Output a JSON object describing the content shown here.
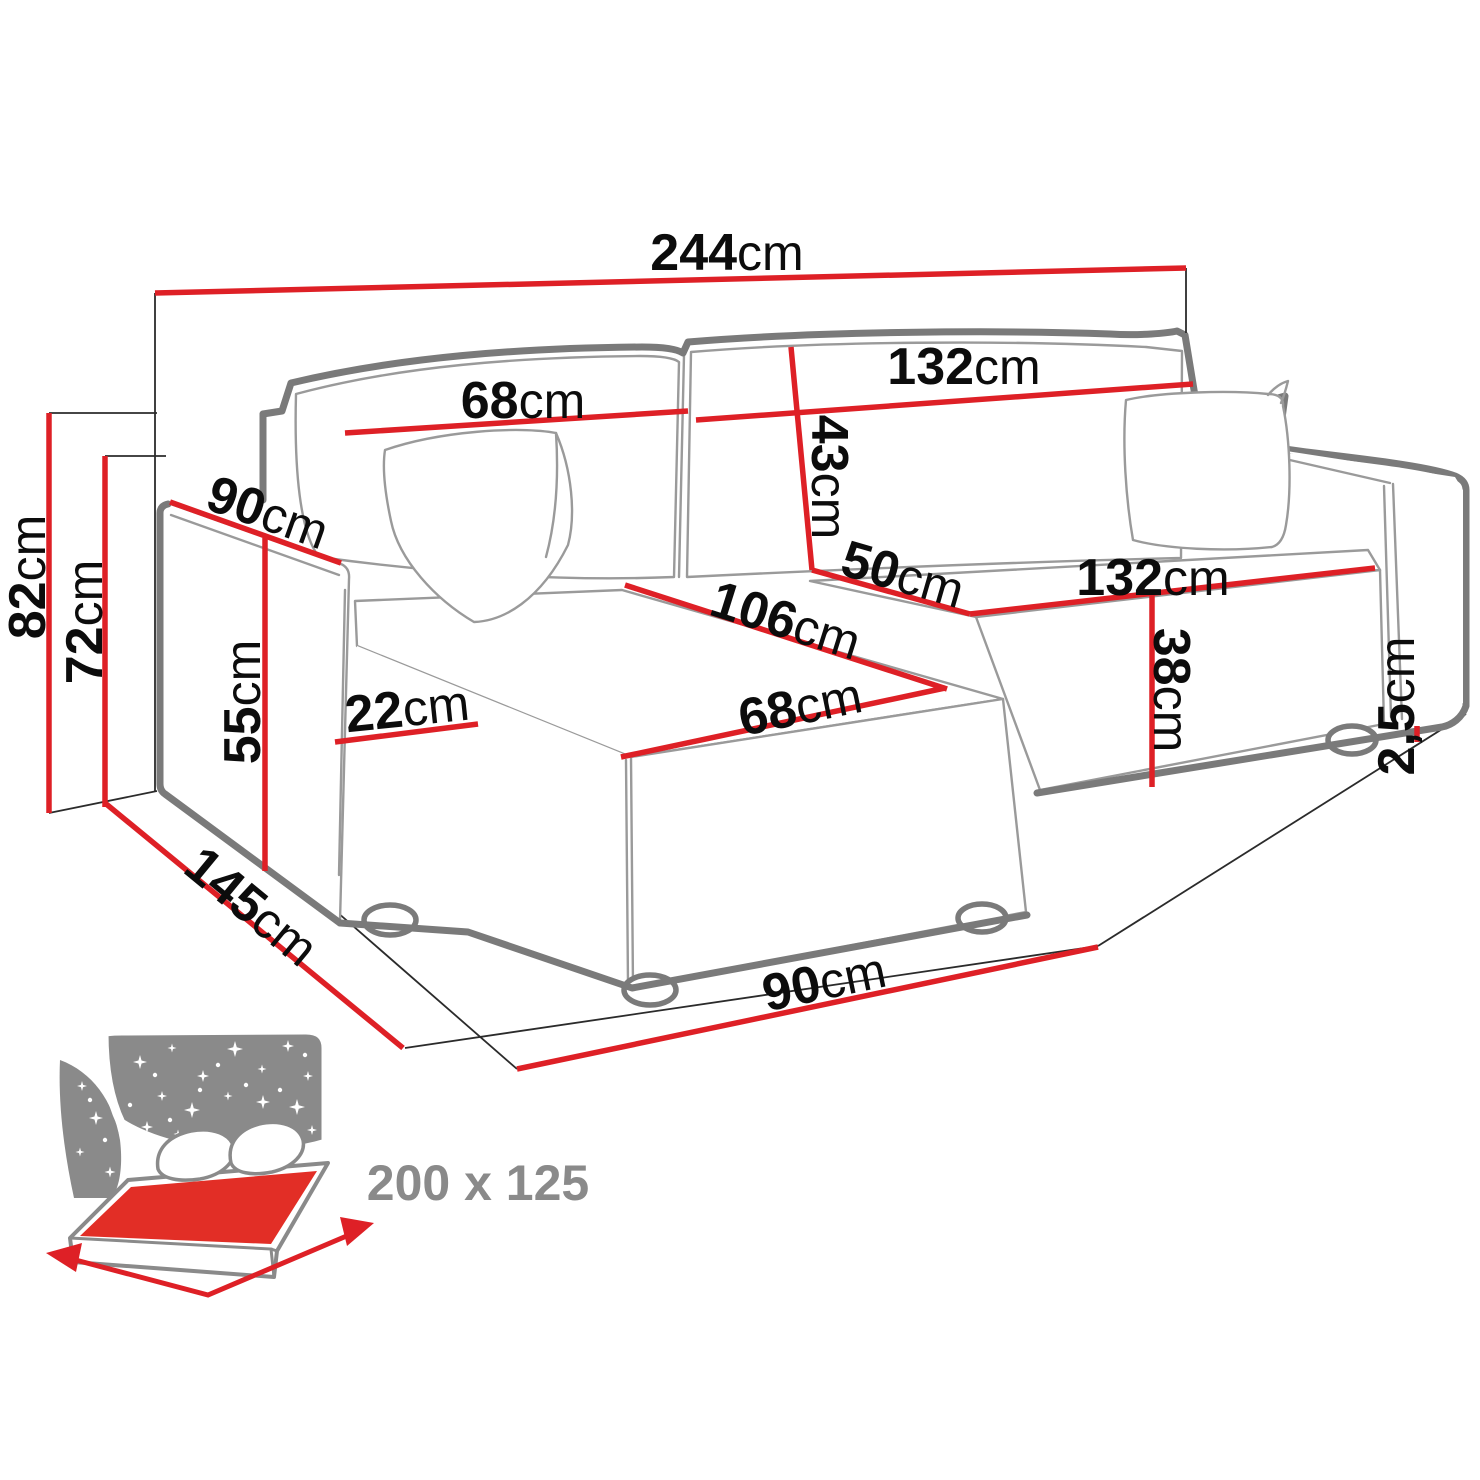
{
  "diagram": {
    "unit": "cm",
    "colors": {
      "dimension_red": "#de2026",
      "outline_gray": "#7a7a7a",
      "detail_gray": "#9a9a9a",
      "label_black": "#0c0c0c",
      "icon_gray": "#8a8a8a",
      "sheet_red": "#e22e26"
    },
    "dims": {
      "d244": {
        "num": "244",
        "unit": "cm"
      },
      "d132top": {
        "num": "132",
        "unit": "cm"
      },
      "d68top": {
        "num": "68",
        "unit": "cm"
      },
      "d43": {
        "num": "43",
        "unit": "cm"
      },
      "d90arm": {
        "num": "90",
        "unit": "cm"
      },
      "d50": {
        "num": "50",
        "unit": "cm"
      },
      "d132seat": {
        "num": "132",
        "unit": "cm"
      },
      "d106": {
        "num": "106",
        "unit": "cm"
      },
      "d68front": {
        "num": "68",
        "unit": "cm"
      },
      "d82": {
        "num": "82",
        "unit": "cm"
      },
      "d72": {
        "num": "72",
        "unit": "cm"
      },
      "d55": {
        "num": "55",
        "unit": "cm"
      },
      "d22": {
        "num": "22",
        "unit": "cm"
      },
      "d38": {
        "num": "38",
        "unit": "cm"
      },
      "d25": {
        "num": "2,5",
        "unit": "cm"
      },
      "d145": {
        "num": "145",
        "unit": "cm"
      },
      "d90floor": {
        "num": "90",
        "unit": "cm"
      }
    },
    "sleeping_area": {
      "label": "200 x 125"
    }
  }
}
